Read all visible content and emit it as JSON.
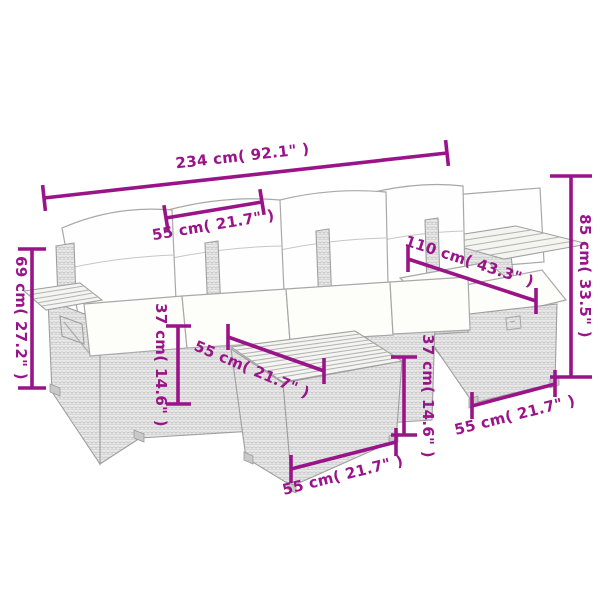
{
  "diagram": {
    "title": "Rattan garden lounge set dimension diagram",
    "accent_color": "#9A1489",
    "line_art_color": "#ABABAB",
    "pieces": [
      "four-seat sofa with cushions",
      "left armrest shelf",
      "corner shelf",
      "wood-top table ottoman",
      "right storage ottoman"
    ],
    "dimensions": {
      "overall_width": {
        "label": "234 cm( 92.1\" )",
        "cm": 234,
        "inches": 92.1
      },
      "seat_section_width": {
        "label": "55 cm( 21.7\" )",
        "cm": 55,
        "inches": 21.7
      },
      "overall_height": {
        "label": "85 cm( 33.5\" )",
        "cm": 85,
        "inches": 33.5
      },
      "corner_depth": {
        "label": "110 cm( 43.3\" )",
        "cm": 110,
        "inches": 43.3
      },
      "armrest_shelf_height": {
        "label": "69 cm( 27.2\" )",
        "cm": 69,
        "inches": 27.2
      },
      "seat_height_left": {
        "label": "37 cm( 14.6\" )",
        "cm": 37,
        "inches": 14.6
      },
      "table_top_depth": {
        "label": "55 cm( 21.7\" )",
        "cm": 55,
        "inches": 21.7
      },
      "table_height": {
        "label": "37 cm( 14.6\" )",
        "cm": 37,
        "inches": 14.6
      },
      "table_width": {
        "label": "55 cm( 21.7\" )",
        "cm": 55,
        "inches": 21.7
      },
      "ottoman_width": {
        "label": "55 cm( 21.7\" )",
        "cm": 55,
        "inches": 21.7
      }
    }
  }
}
